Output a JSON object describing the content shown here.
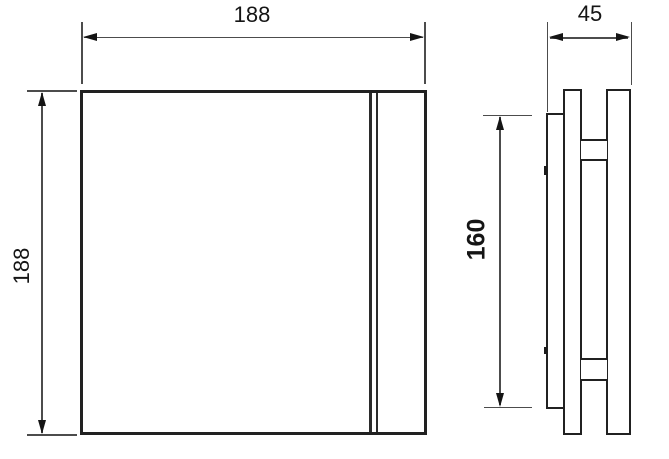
{
  "drawing": {
    "type": "technical-dimension-drawing",
    "views": {
      "front": "front-view",
      "side": "side-profile-view"
    },
    "dimensions": {
      "front_width": "188",
      "front_height": "188",
      "side_depth": "45",
      "side_duct_height": "160"
    },
    "colors": {
      "outline": "#212121",
      "dimension_line": "#4c4c4c",
      "arrow": "#141414",
      "text": "#151515",
      "background": "#ffffff"
    }
  }
}
